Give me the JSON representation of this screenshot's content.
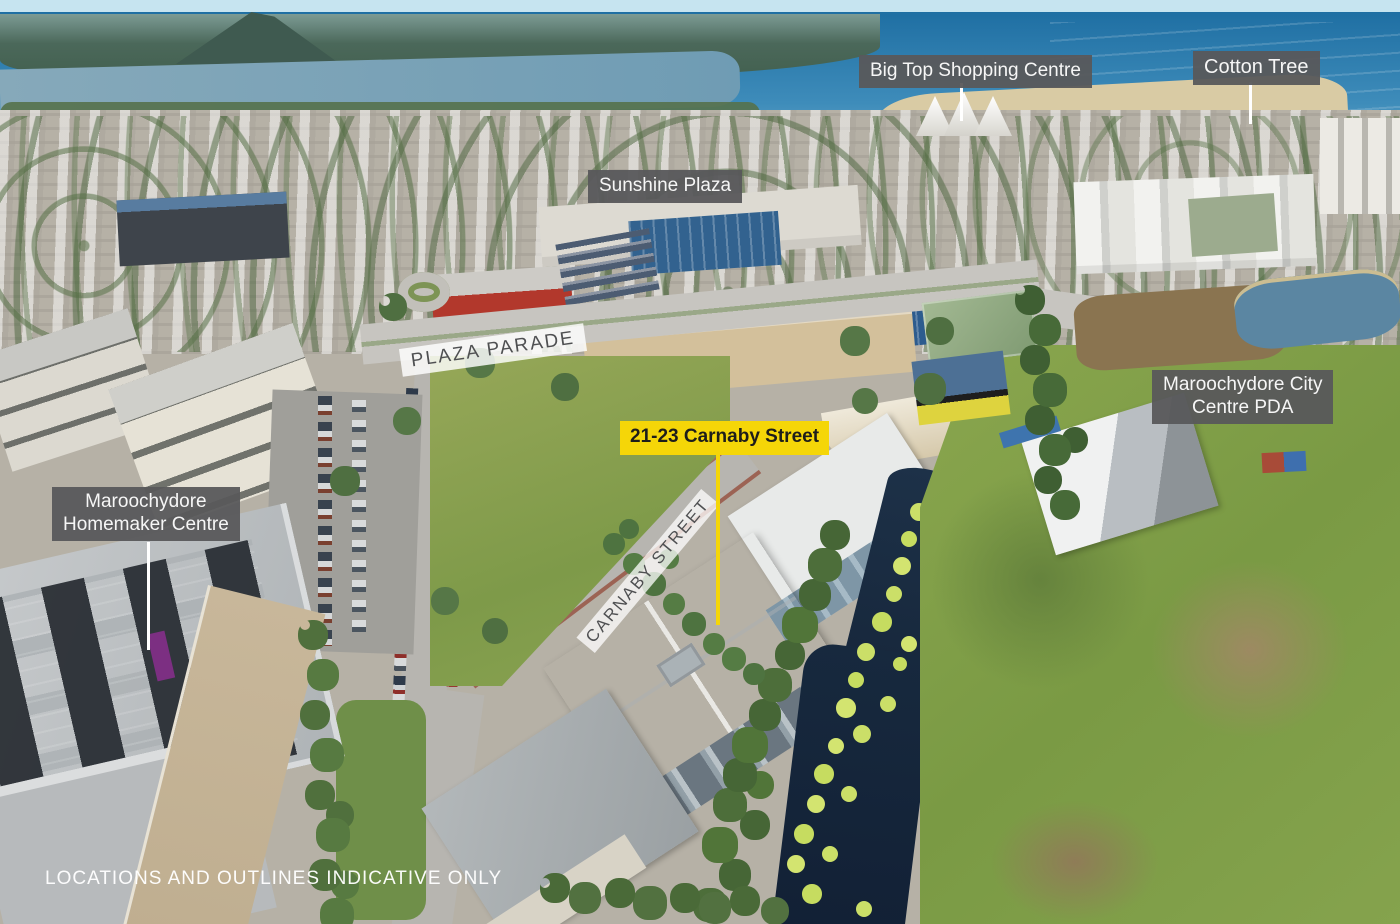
{
  "annotations": {
    "big_top": {
      "text": "Big Top Shopping Centre"
    },
    "cotton_tree": {
      "text": "Cotton Tree"
    },
    "sunshine_plaza": {
      "text": "Sunshine Plaza"
    },
    "subject": {
      "text": "21-23 Carnaby Street"
    },
    "city_centre_pda": {
      "line1": "Maroochydore City",
      "line2": "Centre PDA"
    },
    "homemaker": {
      "line1": "Maroochydore",
      "line2": "Homemaker Centre"
    },
    "streets": {
      "plaza_parade": "PLAZA PARADE",
      "carnaby": "CARNABY STREET"
    },
    "disclaimer": "LOCATIONS AND OUTLINES INDICATIVE ONLY"
  },
  "colors": {
    "label_box": "#58595b",
    "label_text": "#f6f6f6",
    "highlight_box": "#f5d608",
    "highlight_text": "#1d1d1b",
    "street_band": "#ffffff",
    "street_text": "#4f5052",
    "leader_line": "#ffffff",
    "ocean": "#2a7cab",
    "water_channel": "#17293e",
    "algae": "#cbdf68",
    "field_green": "#82a04c"
  }
}
